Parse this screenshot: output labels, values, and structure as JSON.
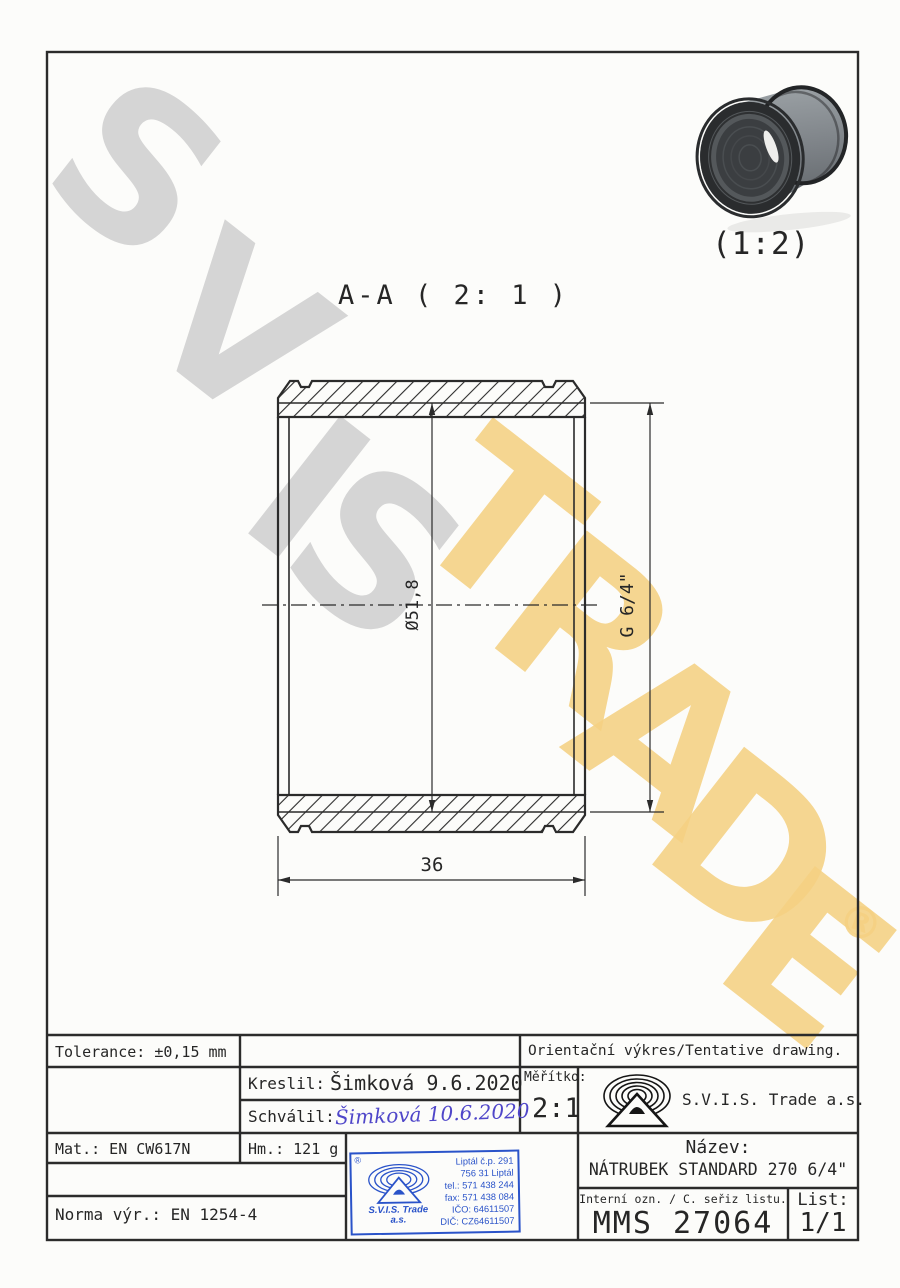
{
  "watermark": {
    "letters": [
      "S",
      "V",
      "I",
      "S",
      "T",
      "R",
      "A",
      "D",
      "E"
    ],
    "registered": "®",
    "gray_color": "#d2d2d2",
    "yellow_color": "#f5d183"
  },
  "drawing": {
    "view_label": "A-A ( 2: 1 )",
    "photo_scale_label": "(1:2)",
    "dim_diameter": "Ø51,8",
    "dim_thread": "G 6/4\"",
    "dim_length": "36",
    "line_color": "#2b2b2b"
  },
  "title_block": {
    "tolerance": "Tolerance: ±0,15 mm",
    "orientacni": "Orientační výkres/Tentative drawing.",
    "kreslil_label": "Kreslil:",
    "kreslil_value": "Šimková 9.6.2020",
    "schvalil_label": "Schválil:",
    "schvalil_value": "Šimková 10.6.2020",
    "meritko_label": "Měřítko:",
    "meritko_value": "2:1",
    "company": "S.V.I.S. Trade a.s.",
    "mat": "Mat.: EN CW617N",
    "hm": "Hm.: 121 g",
    "nazev_label": "Název:",
    "nazev_value": "NÁTRUBEK STANDARD 270 6/4\"",
    "interni_label": "Interní ozn. / C. seřiz listu.",
    "interni_value": "MMS 27064",
    "list_label": "List:",
    "list_value": "1/1",
    "norma": "Norma výr.: EN 1254-4"
  },
  "stamp": {
    "registered": "®",
    "company_line1": "S.V.I.S. Trade",
    "company_line2": "a.s.",
    "address": [
      "Liptál č.p. 291",
      "756 31 Liptál",
      "tel.: 571 438 244",
      "fax: 571 438 084",
      "IČO: 64611507",
      "DIČ: CZ64611507"
    ],
    "color": "#2a53c9"
  }
}
